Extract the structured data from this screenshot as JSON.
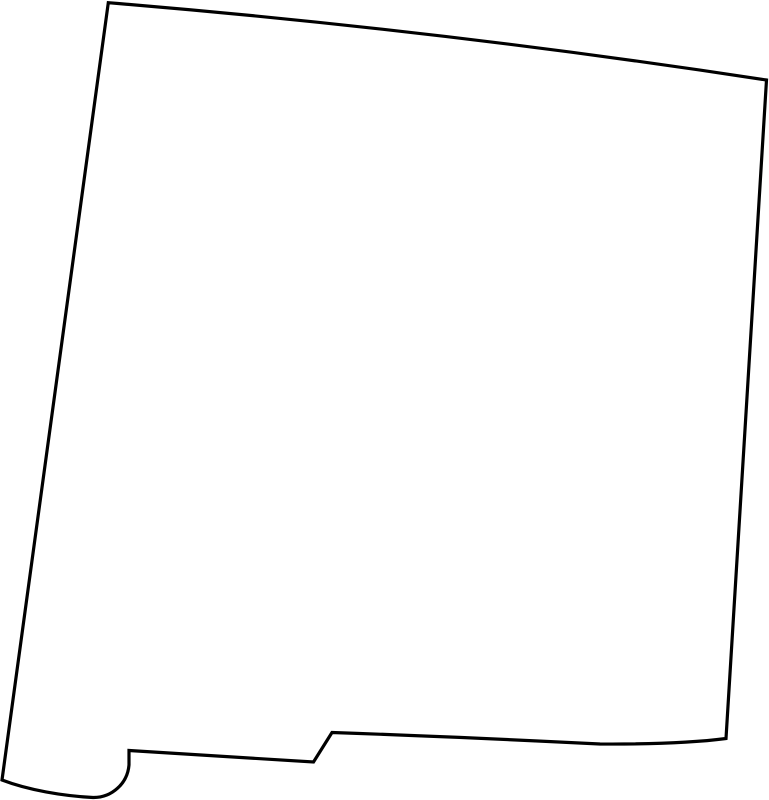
{
  "page": {
    "background_color": "#ffffff",
    "width_px": 769,
    "height_px": 800
  },
  "map": {
    "name": "New Mexico",
    "type": "blank-state-outline-map",
    "view_box": "0 0 769 800",
    "stroke_color": "#000000",
    "fill_color": "#ffffff",
    "stroke_width": 3.2,
    "outline_path": "M 108.3 2.7 Q 440 30 766.5 80 L 726 738.5 Q 680 744.5 600 744 Q 450 736.5 332 732.5 L 313.5 762 L 129 750.5 L 129 765 A 35.5 35.5 0 0 1 93 797.5 C 63 796 28 790 2 780 Z"
  }
}
